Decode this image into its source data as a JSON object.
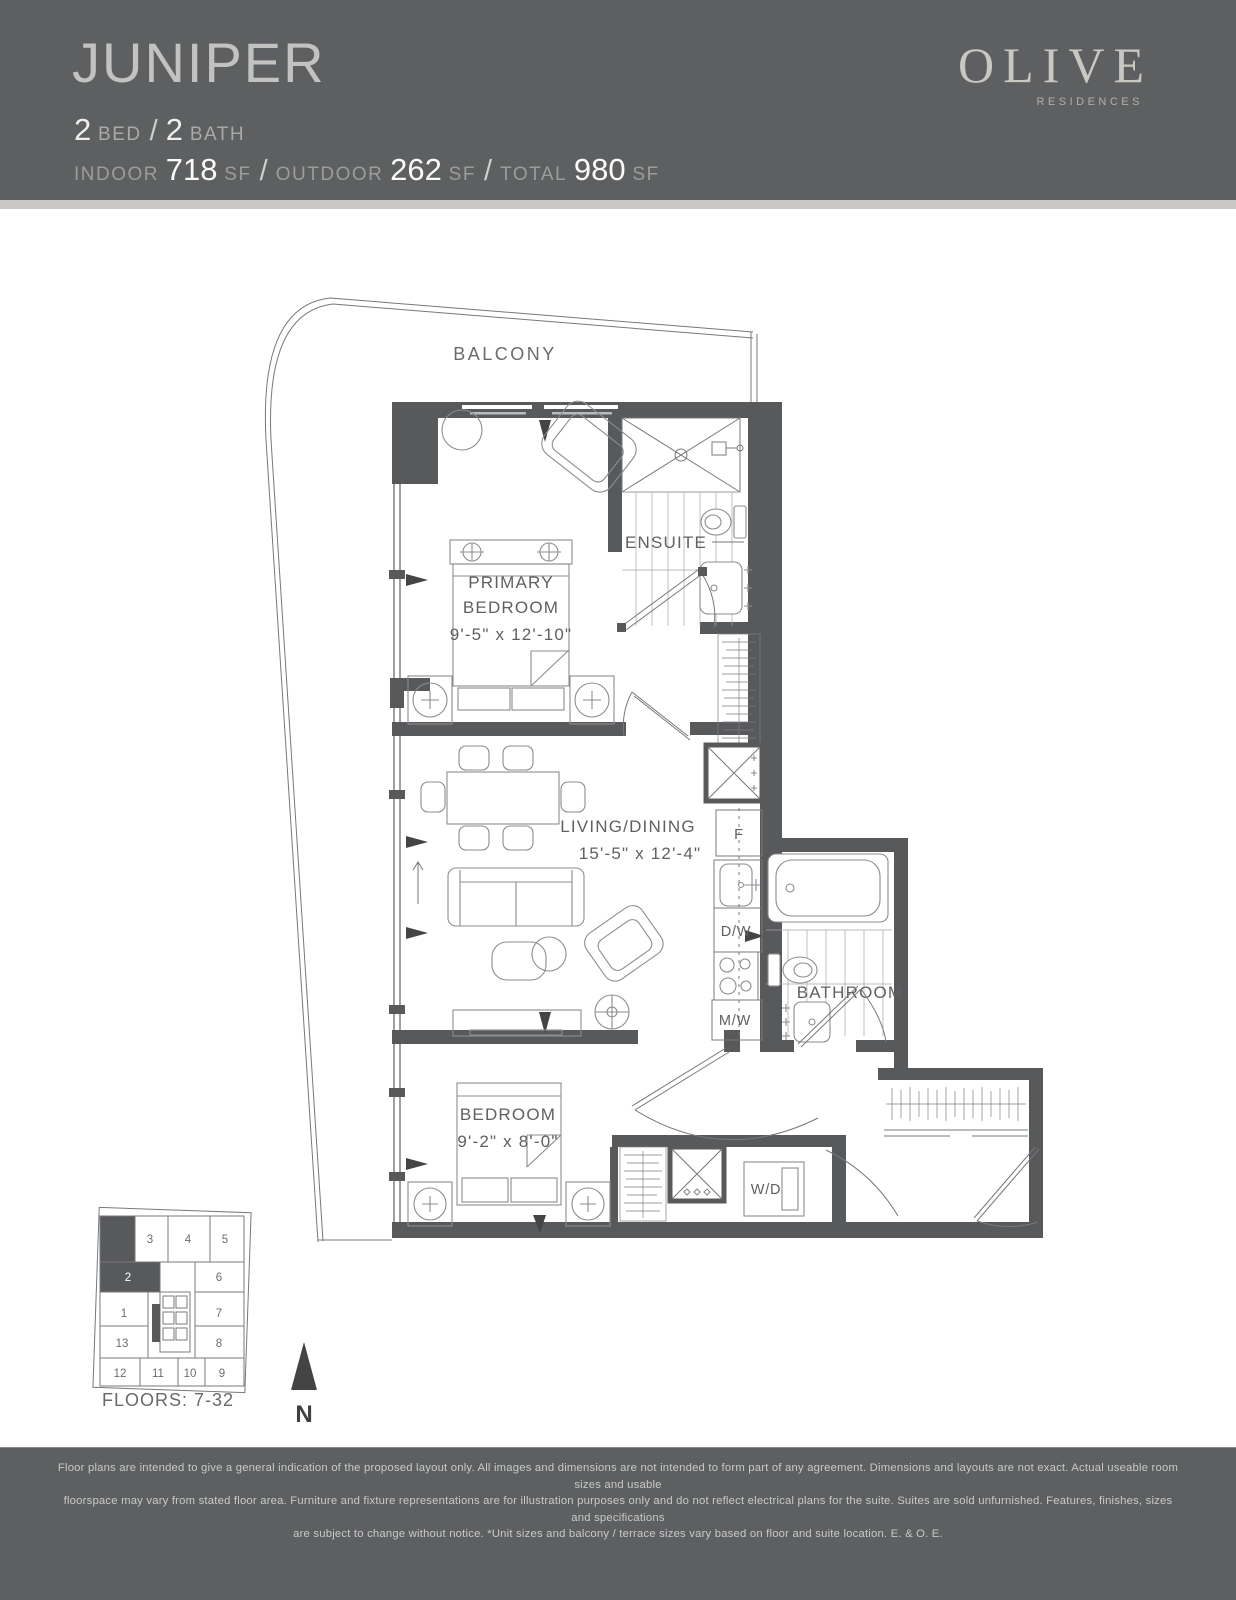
{
  "header": {
    "unit_name": "JUNIPER",
    "bed_count": "2",
    "bed_label": "BED",
    "bath_count": "2",
    "bath_label": "BATH",
    "slash": "/",
    "indoor_label": "INDOOR",
    "indoor_value": "718",
    "outdoor_label": "OUTDOOR",
    "outdoor_value": "262",
    "total_label": "TOTAL",
    "total_value": "980",
    "sf_label": "SF",
    "brand_name": "OLIVE",
    "brand_sub": "RESIDENCES"
  },
  "plan": {
    "balcony": "BALCONY",
    "primary_line1": "PRIMARY",
    "primary_line2": "BEDROOM",
    "primary_dims": "9'-5\" x 12'-10\"",
    "ensuite": "ENSUITE",
    "living_line1": "LIVING/DINING",
    "living_dims": "15'-5\" x 12'-4\"",
    "bathroom": "BATHROOM",
    "bedroom_line1": "BEDROOM",
    "bedroom_dims": "9'-2\" x 8'-0\"",
    "fridge": "F",
    "dishwasher": "D/W",
    "microwave": "M/W",
    "washer_dryer": "W/D"
  },
  "keyplan": {
    "units": [
      "1",
      "2",
      "3",
      "4",
      "5",
      "6",
      "7",
      "8",
      "9",
      "10",
      "11",
      "12",
      "13"
    ],
    "highlighted_unit": "2",
    "floors": "FLOORS: 7-32"
  },
  "compass": {
    "n": "N"
  },
  "footer": {
    "line1": "Floor plans are intended to give a general indication of the proposed layout only. All images and dimensions are not intended to form part of any agreement. Dimensions and layouts are not exact. Actual useable room sizes and usable",
    "line2": "floorspace may vary from stated floor area. Furniture and fixture representations are for illustration purposes only and do not reflect electrical plans for the suite. Suites are sold unfurnished. Features, finishes, sizes and specifications",
    "line3": "are subject to change without notice. *Unit sizes and balcony / terrace sizes vary based on floor and suite location. E. & O. E."
  },
  "colors": {
    "band": "#5e5f61",
    "divider_strip": "#c9c8c4",
    "wall": "#58595b",
    "title_text": "#c2c3c1",
    "value_text": "#fafaf8",
    "plan_text": "#5f6063"
  }
}
